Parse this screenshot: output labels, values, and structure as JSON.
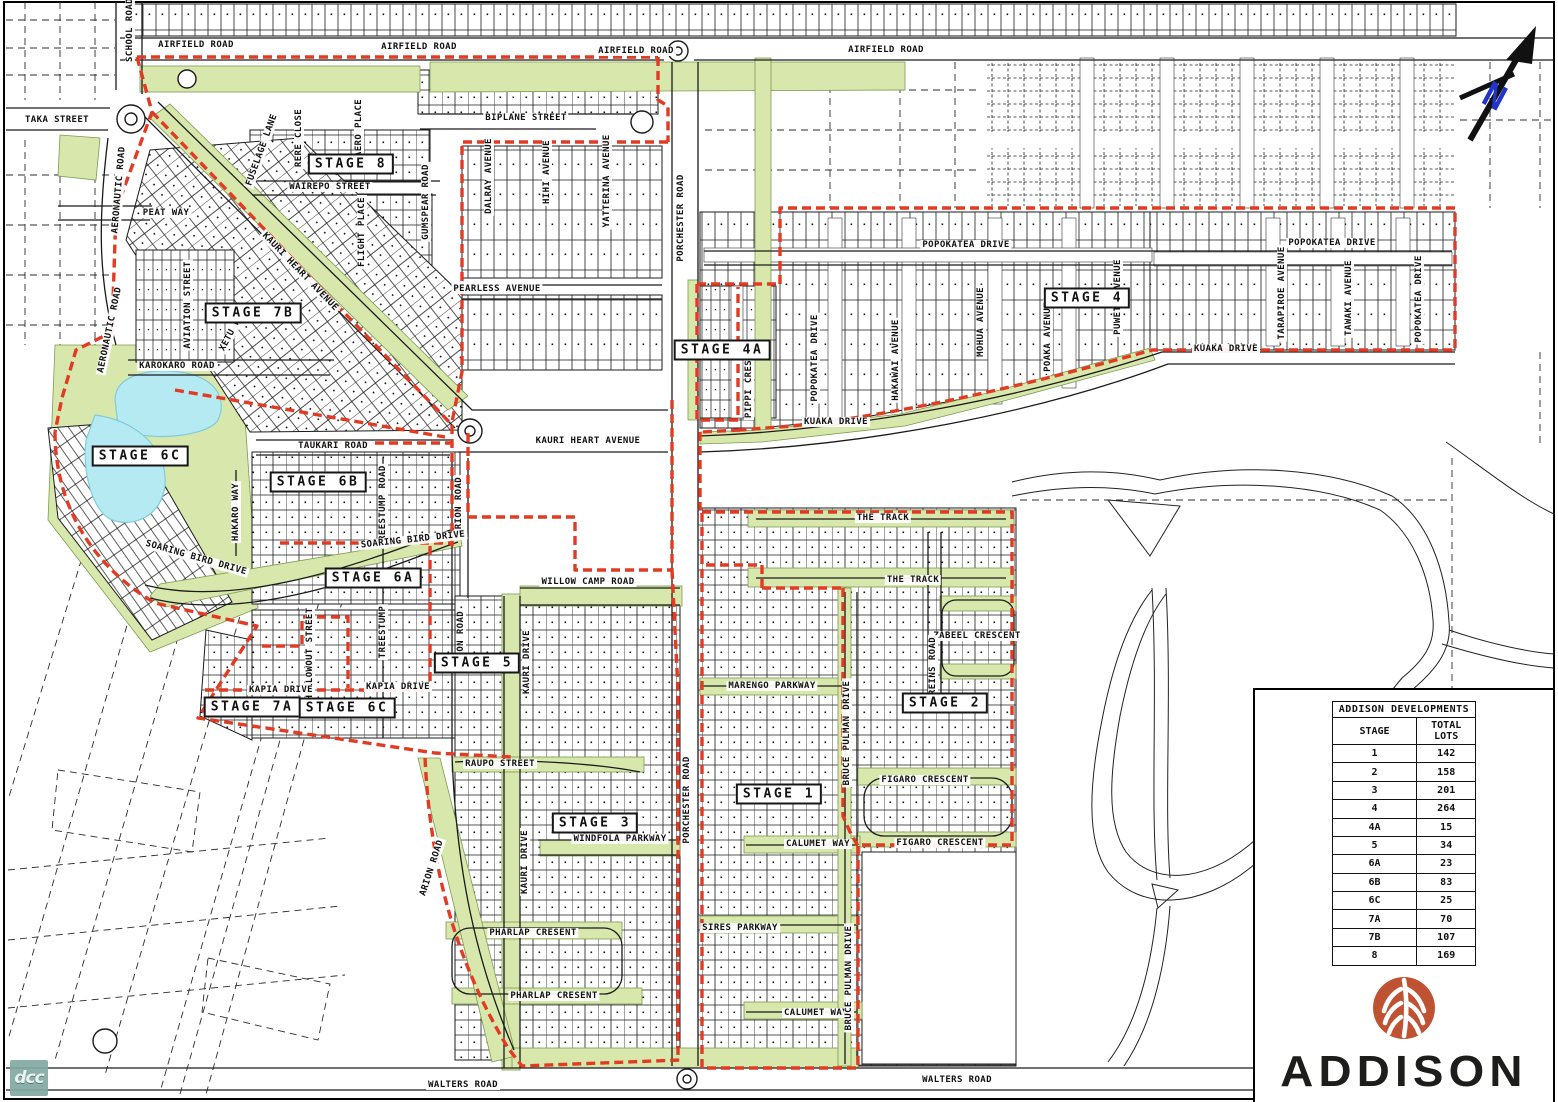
{
  "map": {
    "north_label": "N",
    "street_labels": [
      {
        "text": "SCHOOL ROAD",
        "x": 130,
        "y": 30,
        "r": -90
      },
      {
        "text": "AIRFIELD ROAD",
        "x": 196,
        "y": 45,
        "r": 0
      },
      {
        "text": "AIRFIELD ROAD",
        "x": 419,
        "y": 47,
        "r": 0
      },
      {
        "text": "AIRFIELD ROAD",
        "x": 636,
        "y": 51,
        "r": 0
      },
      {
        "text": "AIRFIELD ROAD",
        "x": 886,
        "y": 50,
        "r": 0
      },
      {
        "text": "TAKA STREET",
        "x": 57,
        "y": 120,
        "r": 0
      },
      {
        "text": "AERONAUTIC ROAD",
        "x": 119,
        "y": 190,
        "r": -85
      },
      {
        "text": "PEAT WAY",
        "x": 166,
        "y": 213,
        "r": 0
      },
      {
        "text": "AVIATION STREET",
        "x": 188,
        "y": 305,
        "r": -90
      },
      {
        "text": "AERONAUTIC ROAD",
        "x": 110,
        "y": 330,
        "r": -78
      },
      {
        "text": "RERE CLOSE",
        "x": 299,
        "y": 138,
        "r": -90
      },
      {
        "text": "AERO PLACE",
        "x": 359,
        "y": 128,
        "r": -90
      },
      {
        "text": "FUSELAGE LANE",
        "x": 262,
        "y": 150,
        "r": -70
      },
      {
        "text": "XETU WAY",
        "x": 233,
        "y": 330,
        "r": -62
      },
      {
        "text": "WAIREPO STREET",
        "x": 330,
        "y": 187,
        "r": 0
      },
      {
        "text": "FLIGHT PLACE",
        "x": 362,
        "y": 232,
        "r": -90
      },
      {
        "text": "GUMSPEAR ROAD",
        "x": 426,
        "y": 202,
        "r": -90
      },
      {
        "text": "BIPLANE STREET",
        "x": 526,
        "y": 118,
        "r": 0
      },
      {
        "text": "DALRAY AVENUE",
        "x": 489,
        "y": 176,
        "r": -90
      },
      {
        "text": "HIHI AVENUE",
        "x": 547,
        "y": 172,
        "r": -90
      },
      {
        "text": "YATTERINA AVENUE",
        "x": 607,
        "y": 181,
        "r": -90
      },
      {
        "text": "PORCHESTER ROAD",
        "x": 681,
        "y": 218,
        "r": -90
      },
      {
        "text": "PEARLESS AVENUE",
        "x": 497,
        "y": 289,
        "r": 0
      },
      {
        "text": "KAURI HEART AVENUE",
        "x": 300,
        "y": 272,
        "r": 46
      },
      {
        "text": "KAROKARO ROAD",
        "x": 177,
        "y": 366,
        "r": 0
      },
      {
        "text": "POPOKATEA DRIVE",
        "x": 966,
        "y": 245,
        "r": 0
      },
      {
        "text": "POPOKATEA DRIVE",
        "x": 815,
        "y": 358,
        "r": -90
      },
      {
        "text": "MOHUA AVENUE",
        "x": 981,
        "y": 322,
        "r": -90
      },
      {
        "text": "HAKAWAI AVENUE",
        "x": 896,
        "y": 360,
        "r": -90
      },
      {
        "text": "POAKA AVENUE",
        "x": 1048,
        "y": 337,
        "r": -90
      },
      {
        "text": "PUWETO AVENUE",
        "x": 1118,
        "y": 297,
        "r": -90
      },
      {
        "text": "POPOKATEA DRIVE",
        "x": 1332,
        "y": 243,
        "r": 0
      },
      {
        "text": "TARAPIROE AVENUE",
        "x": 1282,
        "y": 293,
        "r": -90
      },
      {
        "text": "TAWAKI AVENUE",
        "x": 1349,
        "y": 298,
        "r": -90
      },
      {
        "text": "POPOKATEA DRIVE",
        "x": 1419,
        "y": 299,
        "r": -90
      },
      {
        "text": "PIPPI CRES",
        "x": 749,
        "y": 389,
        "r": -90
      },
      {
        "text": "KUAKA DRIVE",
        "x": 836,
        "y": 422,
        "r": 0
      },
      {
        "text": "KUAKA DRIVE",
        "x": 1226,
        "y": 349,
        "r": 0
      },
      {
        "text": "KAURI HEART AVENUE",
        "x": 588,
        "y": 441,
        "r": 0
      },
      {
        "text": "TAUKARI ROAD",
        "x": 333,
        "y": 446,
        "r": 0
      },
      {
        "text": "TREESTUMP ROAD",
        "x": 383,
        "y": 506,
        "r": -90
      },
      {
        "text": "ARION ROAD",
        "x": 459,
        "y": 506,
        "r": -90
      },
      {
        "text": "HAKARO WAY",
        "x": 236,
        "y": 512,
        "r": -90
      },
      {
        "text": "SOARING BIRD DRIVE",
        "x": 196,
        "y": 558,
        "r": 16
      },
      {
        "text": "SOARING BIRD DRIVE",
        "x": 413,
        "y": 540,
        "r": -6
      },
      {
        "text": "WILLOW CAMP ROAD",
        "x": 588,
        "y": 582,
        "r": 0
      },
      {
        "text": "TREESTUMP",
        "x": 383,
        "y": 632,
        "r": -90
      },
      {
        "text": "HOLLOWOUT STREET",
        "x": 310,
        "y": 654,
        "r": -90
      },
      {
        "text": "KAURI DRIVE",
        "x": 527,
        "y": 662,
        "r": -90
      },
      {
        "text": "ARION ROAD",
        "x": 461,
        "y": 640,
        "r": -90
      },
      {
        "text": "KAPIA DRIVE",
        "x": 281,
        "y": 690,
        "r": 0
      },
      {
        "text": "KAPIA DRIVE",
        "x": 398,
        "y": 687,
        "r": 0
      },
      {
        "text": "RAUPO STREET",
        "x": 500,
        "y": 764,
        "r": 0
      },
      {
        "text": "ARION ROAD",
        "x": 432,
        "y": 868,
        "r": -72
      },
      {
        "text": "KAURI DRIVE",
        "x": 525,
        "y": 862,
        "r": -90
      },
      {
        "text": "WINDFOLA PARKWAY",
        "x": 620,
        "y": 839,
        "r": 0
      },
      {
        "text": "PORCHESTER ROAD",
        "x": 687,
        "y": 800,
        "r": -90
      },
      {
        "text": "PHARLAP CRESENT",
        "x": 533,
        "y": 933,
        "r": 0
      },
      {
        "text": "PHARLAP CRESENT",
        "x": 554,
        "y": 996,
        "r": 0
      },
      {
        "text": "WALTERS ROAD",
        "x": 463,
        "y": 1085,
        "r": 0
      },
      {
        "text": "WALTERS ROAD",
        "x": 957,
        "y": 1080,
        "r": 0
      },
      {
        "text": "THE TRACK",
        "x": 883,
        "y": 518,
        "r": 0
      },
      {
        "text": "THE TRACK",
        "x": 913,
        "y": 580,
        "r": 0
      },
      {
        "text": "ZABEEL CRESCENT",
        "x": 977,
        "y": 636,
        "r": 0
      },
      {
        "text": "REINS ROAD",
        "x": 933,
        "y": 666,
        "r": -90
      },
      {
        "text": "MARENGO PARKWAY",
        "x": 772,
        "y": 686,
        "r": 0
      },
      {
        "text": "BRUCE PULMAN DRIVE",
        "x": 847,
        "y": 733,
        "r": -90
      },
      {
        "text": "FIGARO CRESCENT",
        "x": 925,
        "y": 780,
        "r": 0
      },
      {
        "text": "FIGARO CRESCENT",
        "x": 940,
        "y": 843,
        "r": 0
      },
      {
        "text": "CALUMET WAY",
        "x": 818,
        "y": 844,
        "r": 0
      },
      {
        "text": "SIRES PARKWAY",
        "x": 740,
        "y": 928,
        "r": 0
      },
      {
        "text": "CALUMET WAY",
        "x": 816,
        "y": 1013,
        "r": 0
      },
      {
        "text": "BRUCE PULMAN DRIVE",
        "x": 849,
        "y": 978,
        "r": -90
      }
    ],
    "stage_labels": [
      {
        "text": "STAGE 8",
        "x": 351,
        "y": 164
      },
      {
        "text": "STAGE 7B",
        "x": 253,
        "y": 313
      },
      {
        "text": "STAGE 4A",
        "x": 722,
        "y": 350
      },
      {
        "text": "STAGE 4",
        "x": 1087,
        "y": 298
      },
      {
        "text": "STAGE 6C",
        "x": 140,
        "y": 456
      },
      {
        "text": "STAGE 6B",
        "x": 318,
        "y": 482
      },
      {
        "text": "STAGE 6A",
        "x": 373,
        "y": 578
      },
      {
        "text": "STAGE 5",
        "x": 477,
        "y": 663
      },
      {
        "text": "STAGE 7A",
        "x": 252,
        "y": 707
      },
      {
        "text": "STAGE 6C",
        "x": 347,
        "y": 708
      },
      {
        "text": "STAGE 3",
        "x": 595,
        "y": 823
      },
      {
        "text": "STAGE 2",
        "x": 945,
        "y": 703
      },
      {
        "text": "STAGE 1",
        "x": 779,
        "y": 794
      }
    ]
  },
  "legend": {
    "table_title": "ADDISON DEVELOPMENTS",
    "col_stage": "STAGE",
    "col_total": "TOTAL LOTS",
    "rows": [
      {
        "stage": "1",
        "lots": "142"
      },
      {
        "stage": "2",
        "lots": "158"
      },
      {
        "stage": "3",
        "lots": "201"
      },
      {
        "stage": "4",
        "lots": "264"
      },
      {
        "stage": "4A",
        "lots": "15"
      },
      {
        "stage": "5",
        "lots": "34"
      },
      {
        "stage": "6A",
        "lots": "23"
      },
      {
        "stage": "6B",
        "lots": "83"
      },
      {
        "stage": "6C",
        "lots": "25"
      },
      {
        "stage": "7A",
        "lots": "70"
      },
      {
        "stage": "7B",
        "lots": "107"
      },
      {
        "stage": "8",
        "lots": "169"
      }
    ],
    "brand": "ADDISON",
    "logo_color": "#bf5233"
  },
  "watermark": "dcc",
  "colors": {
    "boundary_red": "#e23b23",
    "reserve_green": "#d8e7ac",
    "pond_blue": "#b5eaf3",
    "north_blue": "#2233cc"
  }
}
